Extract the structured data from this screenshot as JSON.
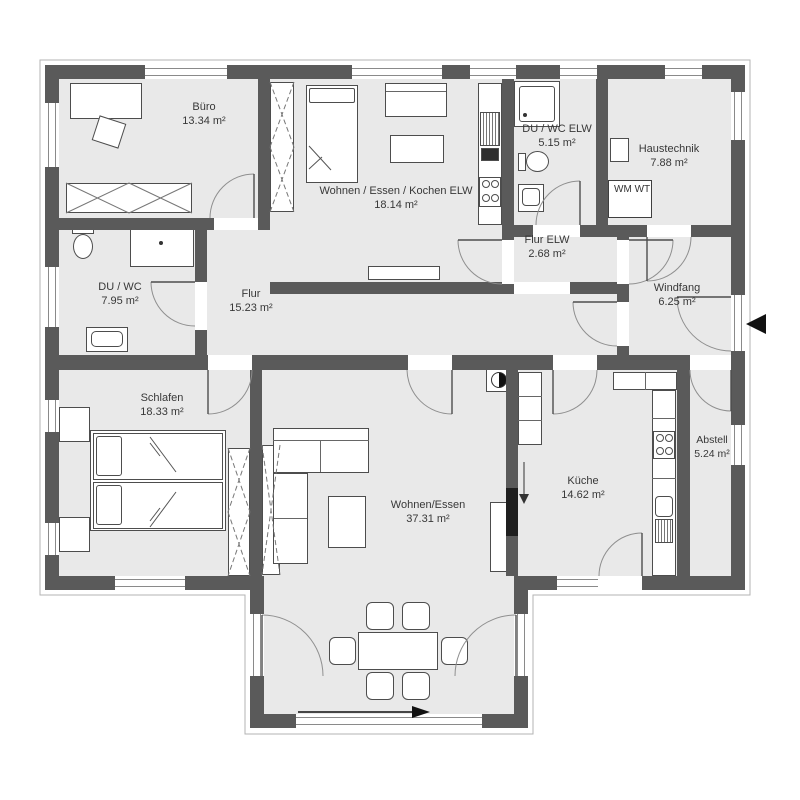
{
  "rooms": {
    "buero": {
      "name": "Büro",
      "area": "13.34 m²"
    },
    "wohnen_elw": {
      "name": "Wohnen / Essen / Kochen ELW",
      "area": "18.14 m²"
    },
    "du_wc_elw": {
      "name": "DU / WC ELW",
      "area": "5.15 m²"
    },
    "haustechnik": {
      "name": "Haustechnik",
      "area": "7.88 m²"
    },
    "flur_elw": {
      "name": "Flur ELW",
      "area": "2.68 m²"
    },
    "windfang": {
      "name": "Windfang",
      "area": "6.25 m²"
    },
    "du_wc": {
      "name": "DU / WC",
      "area": "7.95 m²"
    },
    "flur": {
      "name": "Flur",
      "area": "15.23 m²"
    },
    "schlafen": {
      "name": "Schlafen",
      "area": "18.33 m²"
    },
    "wohnen_essen": {
      "name": "Wohnen/Essen",
      "area": "37.31 m²"
    },
    "kueche": {
      "name": "Küche",
      "area": "14.62 m²"
    },
    "abstell": {
      "name": "Abstell",
      "area": "5.24 m²"
    }
  },
  "appliances": {
    "wm": "WM",
    "wt": "WT"
  },
  "colors": {
    "wall": "#5a5a5a",
    "room_fill": "#e9e9e9",
    "text": "#383838"
  }
}
